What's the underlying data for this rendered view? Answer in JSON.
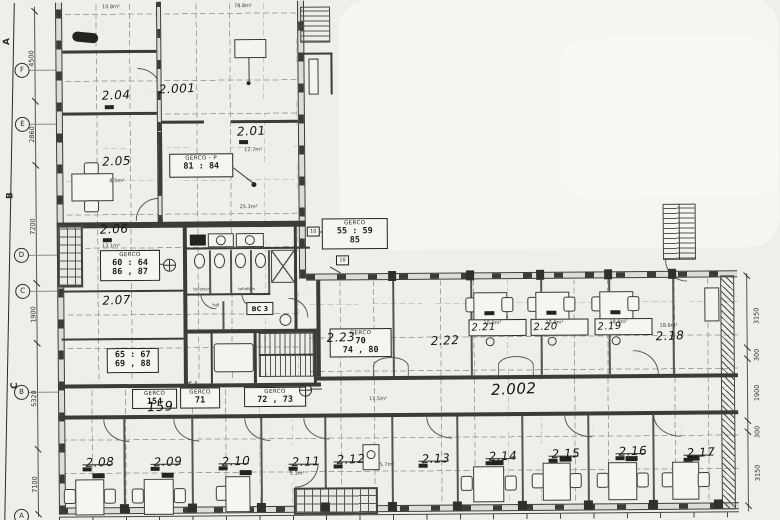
{
  "labels": {
    "r204": "2.04",
    "r2001": "2.001",
    "r201": "2.01",
    "r205": "2.05",
    "r206": "2.06",
    "r207": "2.07",
    "r208": "2.08",
    "r209": "2.09",
    "r210": "2.10",
    "r211": "2.11",
    "r212": "2.12",
    "r213": "2.13",
    "r214": "2.14",
    "r215": "2.15",
    "r216": "2.16",
    "r217": "2.17",
    "r218": "2.18",
    "r219": "2.19",
    "r220": "2.20",
    "r221": "2.21",
    "r222": "2.22",
    "r223": "2.23",
    "r2002": "2.002",
    "g159": "159"
  },
  "boxes": {
    "p8184": {
      "t": "GERCO - P",
      "l1": "81 : 84"
    },
    "g5559": {
      "t": "GERCO",
      "l1": "55 : 59",
      "l2": "85"
    },
    "g6064": {
      "t": "GERCO",
      "l1": "60 : 64",
      "l2": "86 , 87"
    },
    "g6567": {
      "l1": "65 : 67",
      "l2": "69 , 88"
    },
    "g154": {
      "t": "GERCO",
      "l1": "154"
    },
    "g71": {
      "t": "GERCO",
      "l1": "71"
    },
    "g7273": {
      "t": "GERCO",
      "l1": "72 , 73"
    },
    "g7074": {
      "t": "GERCO",
      "l1": "70",
      "l2": "74 , 80"
    }
  },
  "areas": {
    "a204": "10.8m²",
    "a2001": "78.8m²",
    "a201a": "12.7m²",
    "a201b": "25.3m²",
    "a206": "13.1m²",
    "a205": "8.5m²",
    "a221": "18.0m²",
    "a220": "18.0m²",
    "a219": "18.0m²",
    "a218": "18.6m²",
    "a211": "5.1m²",
    "a212": "5.7m²",
    "a222": "11.5m²"
  },
  "tags": {
    "toilet1": "toiletten",
    "toilet2": "toiletten",
    "hal": "hal",
    "bc3": "BC 3",
    "bc1": "BC 1",
    "w10a": "10",
    "w10b": "10"
  },
  "dims": {
    "left": [
      "4500",
      "2860",
      "7200",
      "1900",
      "5320",
      "7100"
    ],
    "right": [
      "3150",
      "300",
      "1900",
      "300",
      "3150"
    ]
  },
  "grid": {
    "bubbles": [
      "F",
      "E",
      "D",
      "C",
      "B",
      "A"
    ],
    "sections": [
      "A",
      "B",
      "C"
    ]
  }
}
